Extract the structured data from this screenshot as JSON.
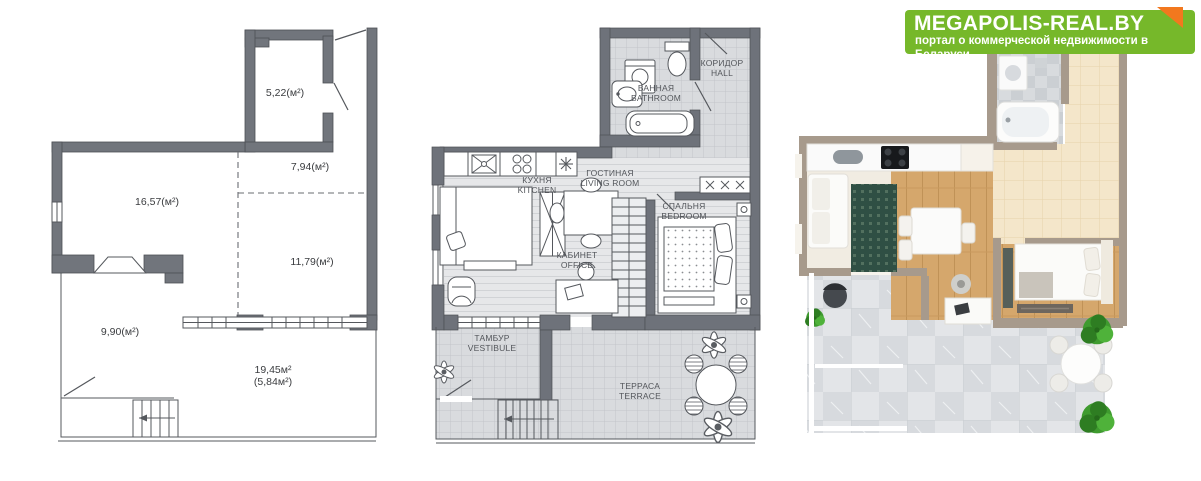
{
  "logo": {
    "title": "MEGAPOLIS-REAL.BY",
    "subtitle": "портал о коммерческой недвижимости в Беларуси",
    "bg_color": "#76b82a",
    "corner_color": "#f2781e",
    "text_color": "#ffffff"
  },
  "schematic_plan": {
    "areas": {
      "room1": "5,22(м²)",
      "room2": "7,94(м²)",
      "room3": "16,57(м²)",
      "room4": "11,79(м²)",
      "room5": "9,90(м²)",
      "terrace_total": "19,45м²",
      "terrace_sub": "(5,84м²)"
    }
  },
  "detailed_plan": {
    "rooms": {
      "hall": {
        "ru": "КОРИДОР",
        "en": "HALL"
      },
      "bathroom": {
        "ru": "ВАННАЯ",
        "en": "BATHROOM"
      },
      "kitchen": {
        "ru": "КУХНЯ",
        "en": "KITCHEN"
      },
      "living": {
        "ru": "ГОСТИНАЯ",
        "en": "LIVING ROOM"
      },
      "bedroom": {
        "ru": "СПАЛЬНЯ",
        "en": "BEDROOM"
      },
      "office": {
        "ru": "КАБИНЕТ",
        "en": "OFFICE"
      },
      "vestibule": {
        "ru": "ТАМБУР",
        "en": "VESTIBULE"
      },
      "terrace": {
        "ru": "ТЕРРАСА",
        "en": "TERRACE"
      }
    }
  },
  "render_3d": {
    "colors": {
      "wall": "#a79a8c",
      "beige_tile": "#f4e6ca",
      "wood_floor": "#d5a76c",
      "marble_tile": "#dfe1e4",
      "rug": "#2f4f44",
      "plant": "#3f9b2f"
    }
  }
}
